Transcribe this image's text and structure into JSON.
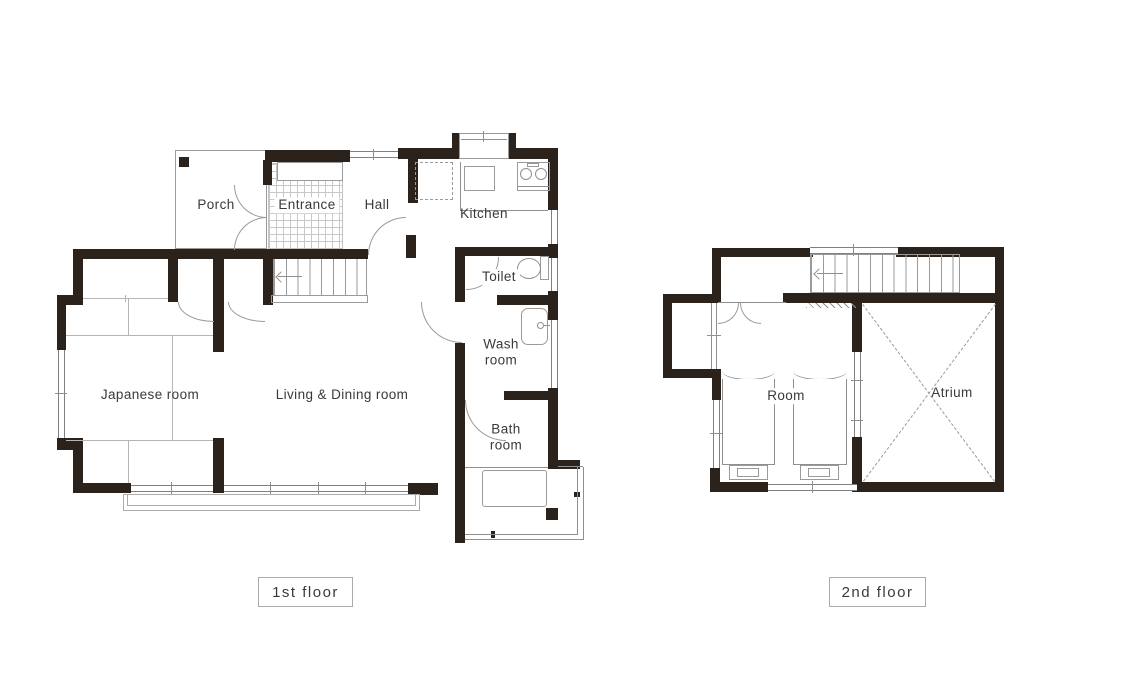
{
  "page": {
    "background": "#ffffff"
  },
  "colors": {
    "wall": "#2b221b",
    "line": "#8f8f8f",
    "light_line": "#b5b5b5",
    "text": "#3a3a3a"
  },
  "floor1": {
    "caption": "1st floor",
    "rooms": {
      "porch": "Porch",
      "entrance": "Entrance",
      "hall": "Hall",
      "kitchen": "Kitchen",
      "toilet": "Toilet",
      "wash_room": "Wash\nroom",
      "bath_room": "Bath\nroom",
      "japanese_room": "Japanese room",
      "living_dining": "Living & Dining room"
    }
  },
  "floor2": {
    "caption": "2nd floor",
    "rooms": {
      "room": "Room",
      "atrium": "Atrium"
    }
  }
}
